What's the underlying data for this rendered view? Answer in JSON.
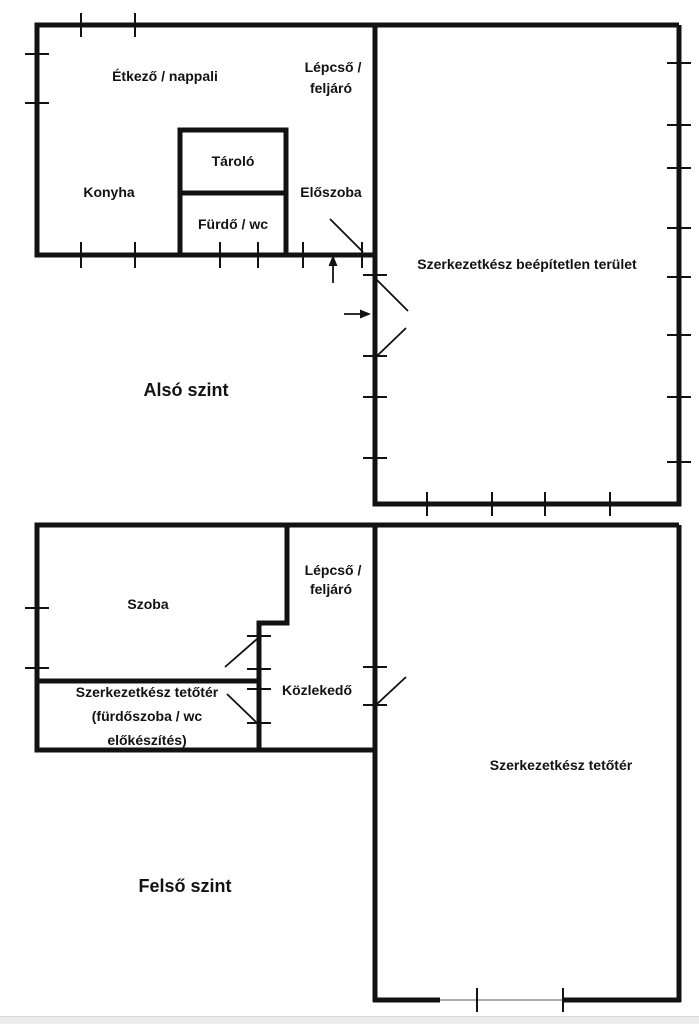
{
  "page": {
    "background_color": "#ffffff",
    "line_color": "#121212",
    "footer_bar_color": "#ececec"
  },
  "ground_floor": {
    "title": "Alsó szint",
    "rooms": {
      "dining_living": "Étkező / nappali",
      "stairs_line1": "Lépcső /",
      "stairs_line2": "feljáró",
      "kitchen": "Konyha",
      "storage": "Tároló",
      "bathroom": "Fürdő / wc",
      "hall": "Előszoba",
      "unbuilt_area": "Szerkezetkész beépítetlen terület"
    }
  },
  "upper_floor": {
    "title": "Felső szint",
    "rooms": {
      "room": "Szoba",
      "stairs_line1": "Lépcső /",
      "stairs_line2": "feljáró",
      "attic_prep_line1": "Szerkezetkész tetőtér",
      "attic_prep_line2": "(fürdőszoba / wc",
      "attic_prep_line3": "előkészítés)",
      "corridor": "Közlekedő",
      "attic": "Szerkezetkész tetőtér"
    }
  }
}
